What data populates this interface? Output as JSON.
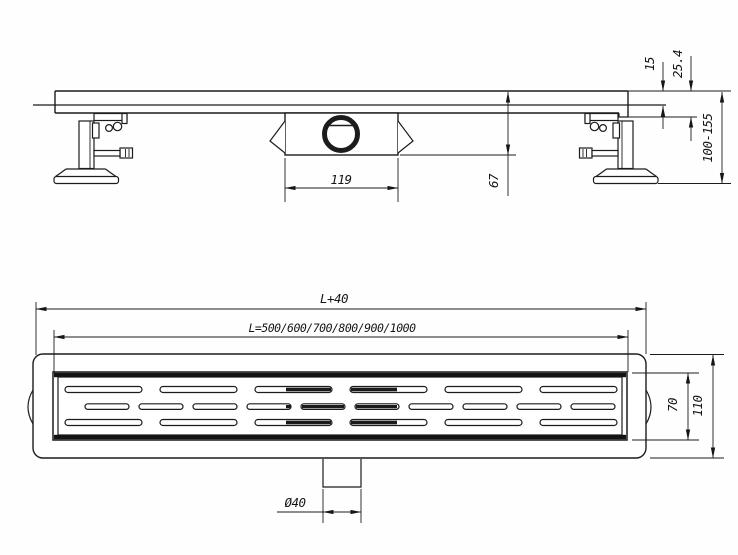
{
  "drawing": {
    "type": "technical-drawing",
    "subject": "linear shower drain channel",
    "line_color": "#1c1c1c",
    "background": "#fefefe",
    "side_view": {
      "labels": {
        "grate_thickness": "15",
        "edge_height": "25.4",
        "adjustable_height_range": "100-155",
        "trap_body_depth": "67",
        "trap_body_width": "119"
      }
    },
    "plan_view": {
      "labels": {
        "overall_length": "L+40",
        "channel_lengths": "L=500/600/700/800/900/1000",
        "outlet_diameter": "Ø40",
        "grate_width": "70",
        "overall_width": "110"
      }
    }
  }
}
